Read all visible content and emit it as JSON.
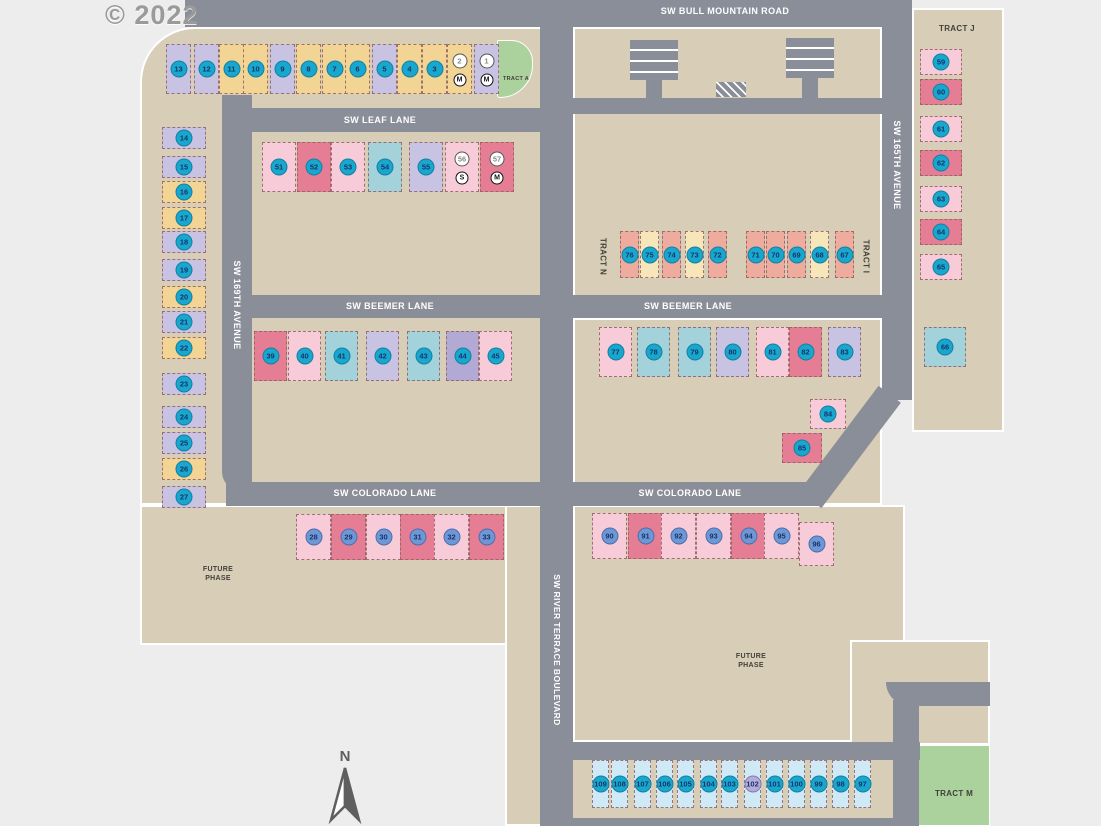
{
  "watermark": "© 2022",
  "north_label": "N",
  "streets": {
    "bull_mountain": "SW BULL MOUNTAIN ROAD",
    "leaf": "SW LEAF LANE",
    "beemer": "SW BEEMER LANE",
    "colorado": "SW COLORADO LANE",
    "ave169": "SW 169TH AVENUE",
    "ave165": "SW 165TH AVENUE",
    "river_terrace": "SW RIVER TERRACE BOULEVARD"
  },
  "tracts": {
    "a": "TRACT A",
    "j": "TRACT J",
    "n": "TRACT N",
    "i": "TRACT I",
    "m": "TRACT M"
  },
  "future_phase": "FUTURE PHASE",
  "palette": {
    "land": "#d8cdb6",
    "road": "#8a8e98",
    "background": "#ededed",
    "tract_green": "#abd19c",
    "house_yellow": "#f2d494",
    "house_lavender": "#c9c3e3",
    "house_purple": "#b2aad4",
    "house_pink": "#f7cbd7",
    "house_red": "#e57e95",
    "house_teal": "#a4d2da",
    "house_salmon": "#eeac9e",
    "house_cream": "#f8e6bb",
    "house_lightblue": "#cfe9f6",
    "badge_teal": "#19a7cd",
    "badge_blue": "#6f97d6",
    "badge_lavender": "#b5abdc",
    "badge_number": "#17356b"
  },
  "lots": {
    "groups": [
      {
        "name": "top-row",
        "y": 44,
        "w": 25,
        "h": 50,
        "items": [
          {
            "n": 13,
            "x": 166,
            "c": "lavender"
          },
          {
            "n": 12,
            "x": 194,
            "c": "lavender"
          },
          {
            "n": 11,
            "x": 219,
            "c": "yellow"
          },
          {
            "n": 10,
            "x": 243,
            "c": "yellow"
          },
          {
            "n": 9,
            "x": 270,
            "c": "lavender"
          },
          {
            "n": 8,
            "x": 296,
            "c": "yellow"
          },
          {
            "n": 7,
            "x": 322,
            "c": "yellow"
          },
          {
            "n": 6,
            "x": 345,
            "c": "yellow"
          },
          {
            "n": 5,
            "x": 372,
            "c": "lavender"
          },
          {
            "n": 4,
            "x": 397,
            "c": "yellow"
          },
          {
            "n": 3,
            "x": 422,
            "c": "yellow"
          },
          {
            "n": 2,
            "x": 447,
            "c": "yellow",
            "b": "white",
            "sym": "M"
          },
          {
            "n": 1,
            "x": 474,
            "c": "lavender",
            "b": "white",
            "sym": "M"
          }
        ]
      },
      {
        "name": "left-column",
        "x": 162,
        "w": 44,
        "h": 22,
        "items": [
          {
            "n": 14,
            "y": 127,
            "c": "lavender"
          },
          {
            "n": 15,
            "y": 156,
            "c": "lavender"
          },
          {
            "n": 16,
            "y": 181,
            "c": "yellow"
          },
          {
            "n": 17,
            "y": 207,
            "c": "yellow"
          },
          {
            "n": 18,
            "y": 231,
            "c": "lavender"
          },
          {
            "n": 19,
            "y": 259,
            "c": "lavender"
          },
          {
            "n": 20,
            "y": 286,
            "c": "yellow"
          },
          {
            "n": 21,
            "y": 311,
            "c": "lavender"
          },
          {
            "n": 22,
            "y": 337,
            "c": "yellow"
          },
          {
            "n": 23,
            "y": 373,
            "c": "lavender"
          },
          {
            "n": 24,
            "y": 406,
            "c": "lavender"
          },
          {
            "n": 25,
            "y": 432,
            "c": "lavender"
          },
          {
            "n": 26,
            "y": 458,
            "c": "yellow"
          },
          {
            "n": 27,
            "y": 486,
            "c": "lavender"
          }
        ]
      },
      {
        "name": "leaf-lane-row",
        "y": 142,
        "w": 34,
        "h": 50,
        "items": [
          {
            "n": 51,
            "x": 262,
            "c": "pink"
          },
          {
            "n": 52,
            "x": 297,
            "c": "red"
          },
          {
            "n": 53,
            "x": 331,
            "c": "pink"
          },
          {
            "n": 54,
            "x": 368,
            "c": "teal"
          },
          {
            "n": 55,
            "x": 409,
            "c": "lavender"
          },
          {
            "n": 56,
            "x": 445,
            "c": "pink",
            "b": "white",
            "sym": "S"
          },
          {
            "n": 57,
            "x": 480,
            "c": "red",
            "b": "white",
            "sym": "M"
          }
        ]
      },
      {
        "name": "middle-row",
        "y": 231,
        "w": 19,
        "h": 47,
        "items": [
          {
            "n": 76,
            "x": 620,
            "c": "salmon"
          },
          {
            "n": 75,
            "x": 640,
            "c": "cream"
          },
          {
            "n": 74,
            "x": 662,
            "c": "salmon"
          },
          {
            "n": 73,
            "x": 685,
            "c": "cream"
          },
          {
            "n": 72,
            "x": 708,
            "c": "salmon"
          },
          {
            "n": 71,
            "x": 746,
            "c": "salmon"
          },
          {
            "n": 70,
            "x": 766,
            "c": "salmon"
          },
          {
            "n": 69,
            "x": 787,
            "c": "salmon"
          },
          {
            "n": 68,
            "x": 810,
            "c": "cream"
          },
          {
            "n": 67,
            "x": 835,
            "c": "salmon"
          }
        ]
      },
      {
        "name": "beemer-left-row",
        "y": 331,
        "w": 33,
        "h": 50,
        "items": [
          {
            "n": 39,
            "x": 254,
            "c": "red"
          },
          {
            "n": 40,
            "x": 288,
            "c": "pink"
          },
          {
            "n": 41,
            "x": 325,
            "c": "teal"
          },
          {
            "n": 42,
            "x": 366,
            "c": "lavender"
          },
          {
            "n": 43,
            "x": 407,
            "c": "teal"
          },
          {
            "n": 44,
            "x": 446,
            "c": "purple"
          },
          {
            "n": 45,
            "x": 479,
            "c": "pink"
          }
        ]
      },
      {
        "name": "beemer-right-row",
        "y": 327,
        "w": 33,
        "h": 50,
        "items": [
          {
            "n": 77,
            "x": 599,
            "c": "pink"
          },
          {
            "n": 78,
            "x": 637,
            "c": "teal"
          },
          {
            "n": 79,
            "x": 678,
            "c": "teal"
          },
          {
            "n": 80,
            "x": 716,
            "c": "lavender"
          },
          {
            "n": 81,
            "x": 756,
            "c": "pink"
          },
          {
            "n": 82,
            "x": 789,
            "c": "red"
          },
          {
            "n": 83,
            "x": 828,
            "c": "lavender"
          }
        ]
      },
      {
        "name": "south-pair",
        "items": [
          {
            "n": 84,
            "x": 810,
            "y": 399,
            "w": 36,
            "h": 30,
            "c": "pink"
          },
          {
            "n": 85,
            "x": 782,
            "y": 433,
            "w": 40,
            "h": 30,
            "c": "red"
          }
        ]
      },
      {
        "name": "east-single",
        "items": [
          {
            "n": 66,
            "x": 924,
            "y": 327,
            "w": 42,
            "h": 40,
            "c": "teal"
          }
        ]
      },
      {
        "name": "right-column",
        "x": 920,
        "w": 42,
        "h": 26,
        "items": [
          {
            "n": 59,
            "y": 49,
            "c": "pink"
          },
          {
            "n": 60,
            "y": 79,
            "c": "red"
          },
          {
            "n": 61,
            "y": 116,
            "c": "pink"
          },
          {
            "n": 62,
            "y": 150,
            "c": "red"
          },
          {
            "n": 63,
            "y": 186,
            "c": "pink"
          },
          {
            "n": 64,
            "y": 219,
            "c": "red"
          },
          {
            "n": 65,
            "y": 254,
            "c": "pink"
          }
        ]
      },
      {
        "name": "colorado-left-row",
        "y": 514,
        "w": 35,
        "h": 46,
        "b": "blue",
        "items": [
          {
            "n": 28,
            "x": 296,
            "c": "pink"
          },
          {
            "n": 29,
            "x": 331,
            "c": "red"
          },
          {
            "n": 30,
            "x": 366,
            "c": "pink"
          },
          {
            "n": 31,
            "x": 400,
            "c": "red"
          },
          {
            "n": 32,
            "x": 434,
            "c": "pink"
          },
          {
            "n": 33,
            "x": 469,
            "c": "red"
          }
        ]
      },
      {
        "name": "colorado-right-row",
        "y": 513,
        "w": 35,
        "h": 46,
        "b": "blue",
        "items": [
          {
            "n": 90,
            "x": 592,
            "c": "pink"
          },
          {
            "n": 91,
            "x": 628,
            "c": "red"
          },
          {
            "n": 92,
            "x": 661,
            "c": "pink"
          },
          {
            "n": 93,
            "x": 696,
            "c": "pink"
          },
          {
            "n": 94,
            "x": 731,
            "c": "red"
          },
          {
            "n": 95,
            "x": 764,
            "c": "pink"
          },
          {
            "n": 96,
            "x": 799,
            "y": 522,
            "h": 44,
            "c": "pink"
          }
        ]
      },
      {
        "name": "bottom-row",
        "y": 760,
        "w": 17,
        "h": 48,
        "c": "lightblue",
        "items": [
          {
            "n": 109,
            "x": 592
          },
          {
            "n": 108,
            "x": 611
          },
          {
            "n": 107,
            "x": 634
          },
          {
            "n": 106,
            "x": 656
          },
          {
            "n": 105,
            "x": 677
          },
          {
            "n": 104,
            "x": 700
          },
          {
            "n": 103,
            "x": 721
          },
          {
            "n": 102,
            "x": 744,
            "b": "lav"
          },
          {
            "n": 101,
            "x": 766
          },
          {
            "n": 100,
            "x": 788
          },
          {
            "n": 99,
            "x": 810
          },
          {
            "n": 98,
            "x": 832
          },
          {
            "n": 97,
            "x": 854
          }
        ]
      }
    ]
  }
}
